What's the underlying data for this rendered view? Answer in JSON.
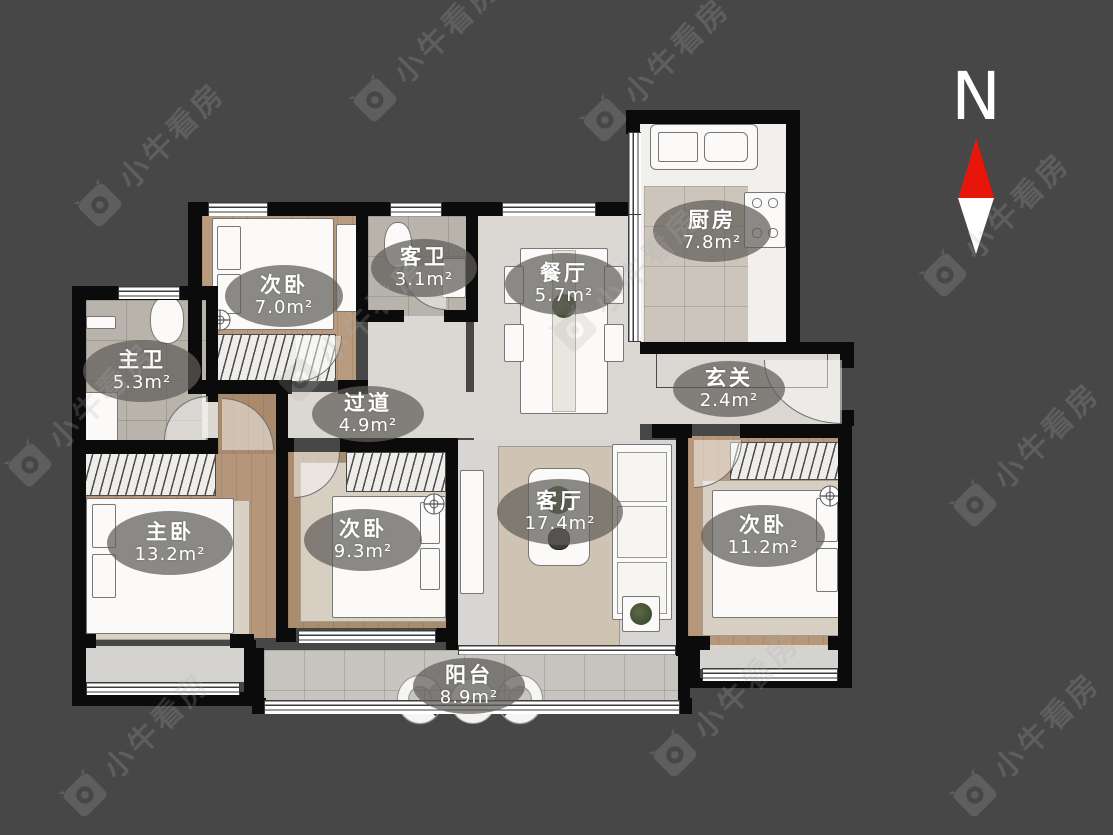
{
  "page": {
    "background_color": "#474747",
    "wall_color": "#0b0b0b"
  },
  "branding": {
    "watermark_text": "小牛看房"
  },
  "compass": {
    "north_label": "N",
    "needle_north_color": "#e8150b",
    "needle_south_color": "#ffffff"
  },
  "floorplan": {
    "rooms": [
      {
        "name": "次卧",
        "area": "7.0m²"
      },
      {
        "name": "客卫",
        "area": "3.1m²"
      },
      {
        "name": "餐厅",
        "area": "5.7m²"
      },
      {
        "name": "厨房",
        "area": "7.8m²"
      },
      {
        "name": "主卫",
        "area": "5.3m²"
      },
      {
        "name": "过道",
        "area": "4.9m²"
      },
      {
        "name": "玄关",
        "area": "2.4m²"
      },
      {
        "name": "主卧",
        "area": "13.2m²"
      },
      {
        "name": "次卧",
        "area": "9.3m²"
      },
      {
        "name": "客厅",
        "area": "17.4m²"
      },
      {
        "name": "次卧",
        "area": "11.2m²"
      },
      {
        "name": "阳台",
        "area": "8.9m²"
      }
    ]
  }
}
